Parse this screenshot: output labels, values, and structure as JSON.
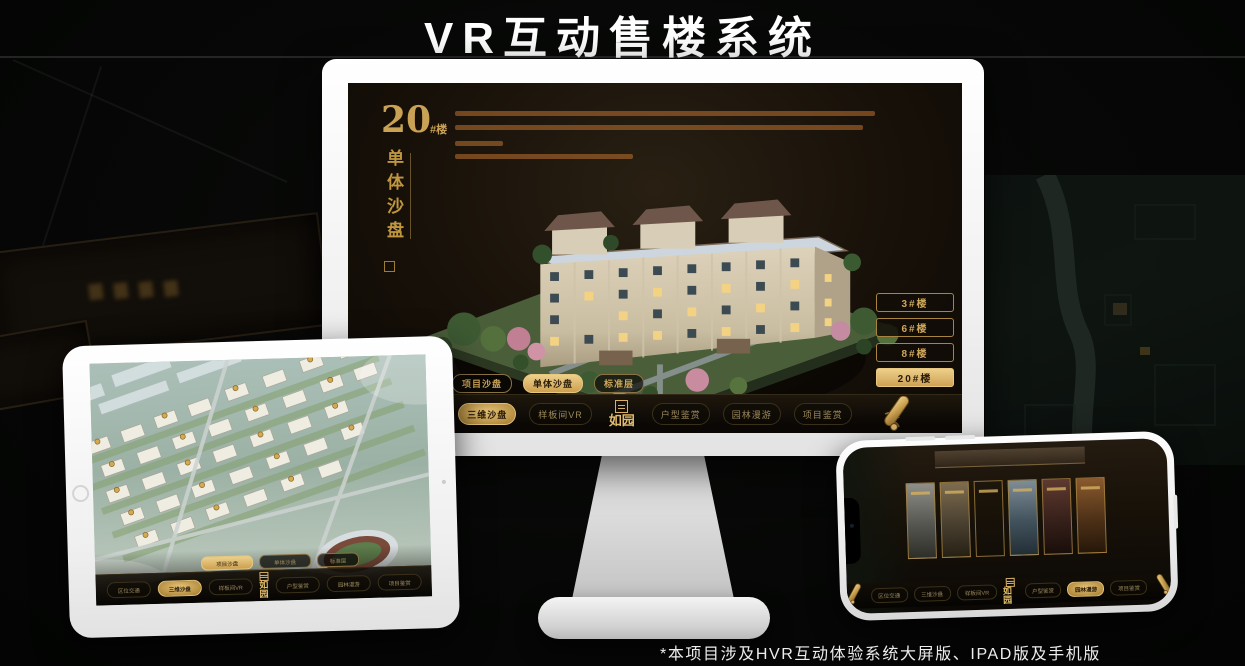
{
  "page": {
    "title": "VR互动售楼系统",
    "footnote": "*本项目涉及HVR互动体验系统大屏版、IPAD版及手机版"
  },
  "colors": {
    "gold": "#c9a255",
    "gold_bright": "#d9b268",
    "screen_bg": "#16100a",
    "title_text": "#ffffff"
  },
  "app": {
    "logo": "如园",
    "tabs": [
      "项目沙盘",
      "单体沙盘",
      "标准层"
    ],
    "nav_items": [
      "区位交通",
      "三维沙盘",
      "样板间VR",
      "户型鉴赏",
      "园林漫游",
      "项目鉴赏"
    ]
  },
  "monitor": {
    "title_number": "20",
    "title_suffix": "#楼",
    "title_vertical": "单体沙盘",
    "floor_buttons": [
      "3#楼",
      "6#楼",
      "8#楼",
      "20#楼"
    ],
    "active_floor": "20#楼",
    "active_tab": "单体沙盘",
    "active_nav": "三维沙盘"
  },
  "tablet": {
    "active_tab": "项目沙盘",
    "active_nav": "三维沙盘"
  },
  "phone": {
    "active_nav": "园林漫游"
  }
}
